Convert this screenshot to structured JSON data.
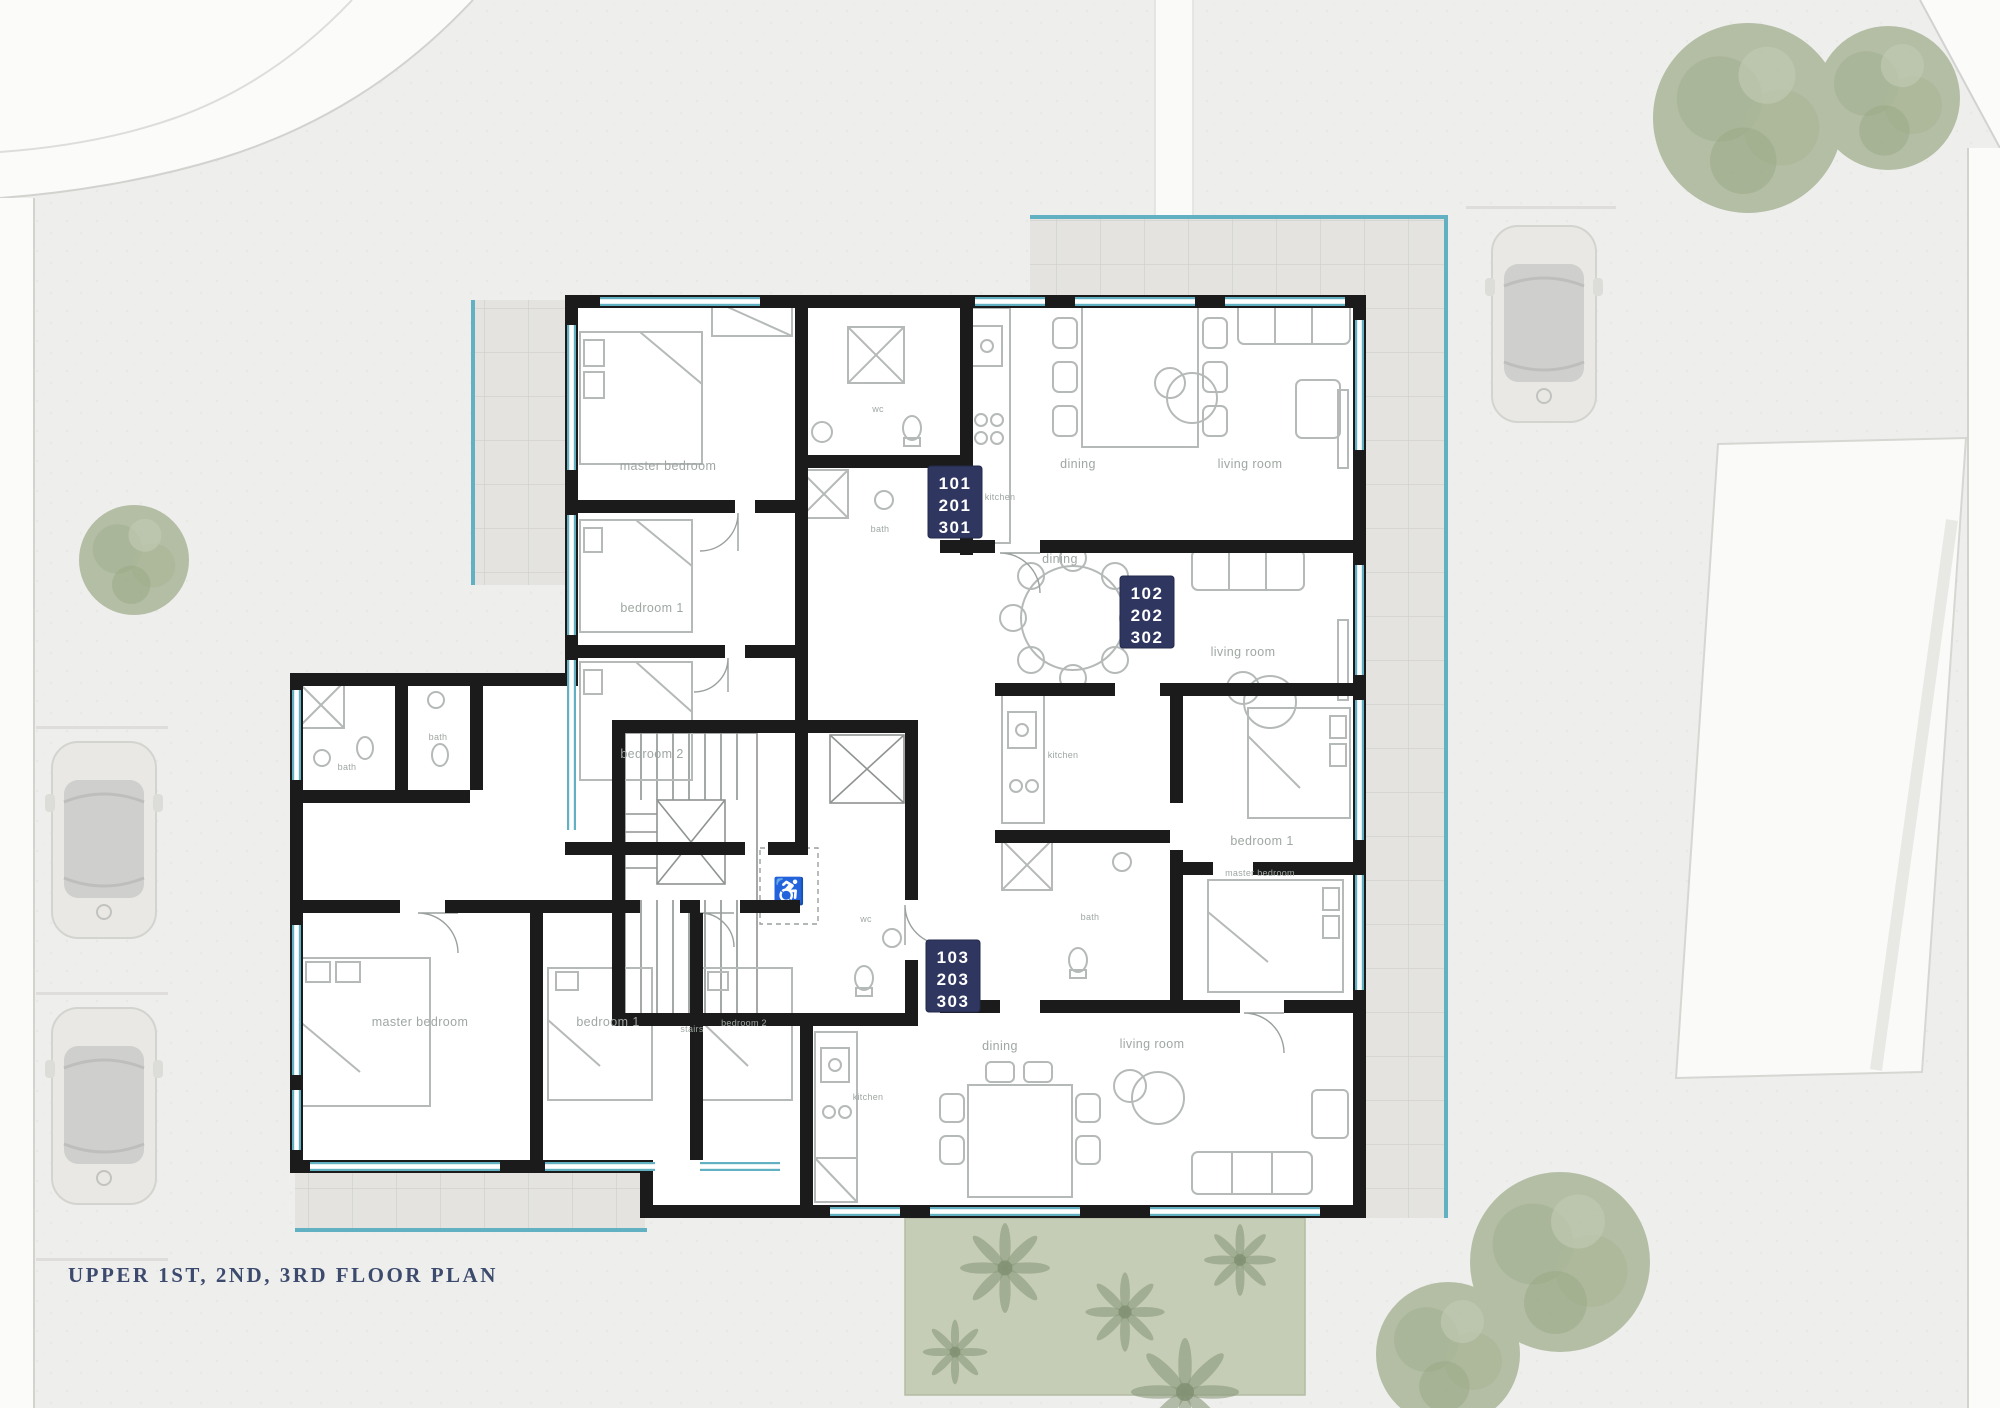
{
  "title": {
    "label": "UPPER 1ST, 2ND, 3RD FLOOR PLAN"
  },
  "colors": {
    "badge_navy": "#2f3660",
    "title_navy": "#3c4a6e",
    "window_teal": "#62b1c2",
    "wall_black": "#1b1b1b",
    "lawn_green": "#c6cdb6",
    "tree_green": "#adb89e",
    "paving_gray": "#eeeeec",
    "furniture_gray": "#b5b9b8"
  },
  "units": [
    {
      "id": "unit-1",
      "levels": [
        "101",
        "201",
        "301"
      ],
      "rooms": {
        "master_bedroom": "master bedroom",
        "bedroom1": "bedroom 1",
        "bedroom2": "bedroom 2",
        "wc": "wc",
        "bath": "bath",
        "kitchen": "kitchen",
        "dining": "dining",
        "living": "living room"
      }
    },
    {
      "id": "unit-2",
      "levels": [
        "102",
        "202",
        "302"
      ],
      "rooms": {
        "dining": "dining",
        "living": "living room",
        "kitchen": "kitchen",
        "bedroom1": "bedroom 1",
        "master_bedroom": "master bedroom",
        "bath": "bath"
      }
    },
    {
      "id": "unit-3",
      "levels": [
        "103",
        "203",
        "303"
      ],
      "rooms": {
        "bath1": "bath",
        "bath2": "bath",
        "master_bedroom": "master bedroom",
        "bedroom1": "bedroom 1",
        "bedroom2": "bedroom 2",
        "kitchen": "kitchen",
        "dining": "dining",
        "living": "living room"
      }
    }
  ],
  "core": {
    "stairs": "stairs",
    "wc": "wc"
  }
}
